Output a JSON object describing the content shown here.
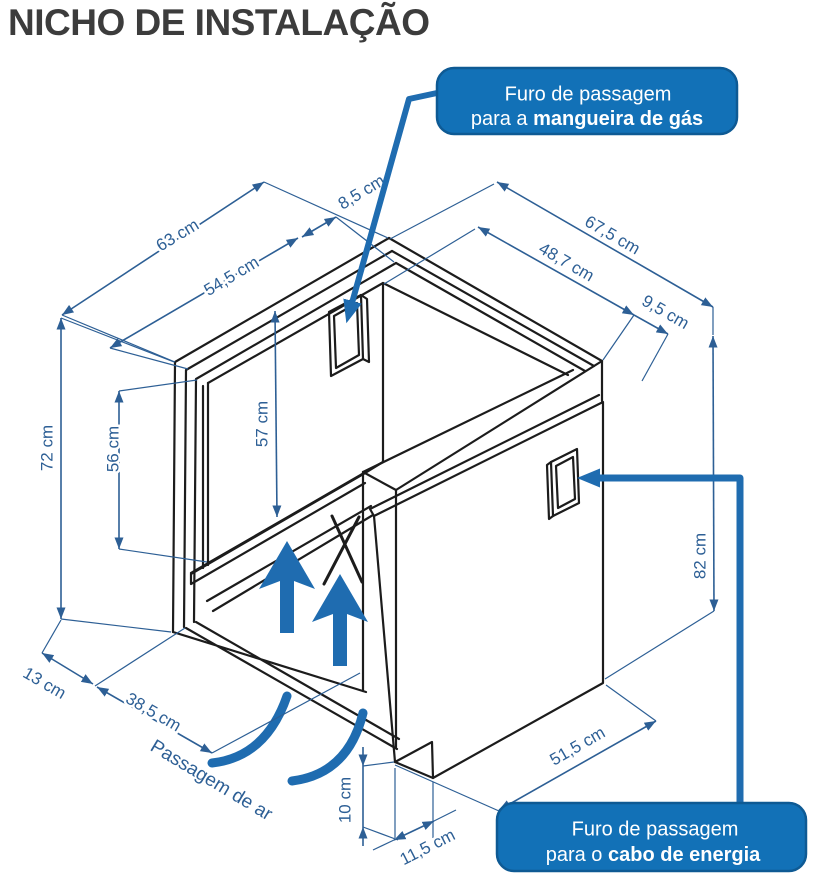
{
  "title": "NICHO DE INSTALAÇÃO",
  "dims": {
    "w_outer": "63 cm",
    "w_inner": "54,5 cm",
    "gap_top": "8,5 cm",
    "d_outer": "67,5 cm",
    "d_inner": "48,7 cm",
    "d_offset": "9,5 cm",
    "h_outer": "72 cm",
    "h_opening": "56 cm",
    "h_interior": "57 cm",
    "h_panel": "82 cm",
    "base_front": "13 cm",
    "air_depth": "38,5 cm",
    "gap_bottom": "10 cm",
    "notch_depth": "11,5 cm",
    "panel_bottom": "51,5 cm"
  },
  "labels": {
    "air_passage": "Passagem de ar"
  },
  "callouts": {
    "gas": {
      "line1": "Furo de passagem",
      "line2_prefix": "para a ",
      "line2_bold": "mangueira de gás"
    },
    "power": {
      "line1": "Furo de passagem",
      "line2_prefix": "para o ",
      "line2_bold": "cabo de energia"
    }
  },
  "colors": {
    "line_art": "#1c1c1c",
    "dimension_blue": "#2d5f95",
    "accent_blue": "#1f6cb0",
    "callout_fill": "#1271b7",
    "callout_border": "#0e5a94",
    "title_color": "#3c3c3c"
  }
}
